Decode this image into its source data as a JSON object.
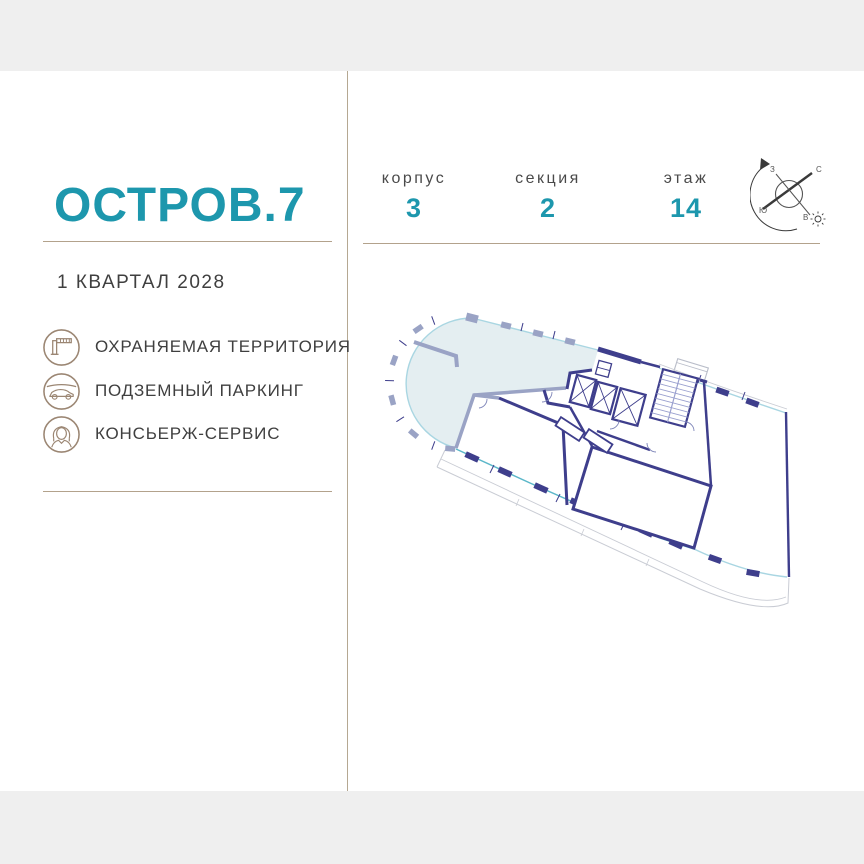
{
  "brand": {
    "logo": "ОСТРОВ.7",
    "completion": "1 КВАРТАЛ 2028",
    "accent_color": "#1d97ad",
    "line_color": "#b3a28c"
  },
  "amenities": [
    {
      "icon": "barrier-icon",
      "label": "ОХРАНЯЕМАЯ ТЕРРИТОРИЯ"
    },
    {
      "icon": "car-icon",
      "label": "ПОДЗЕМНЫЙ ПАРКИНГ"
    },
    {
      "icon": "concierge-icon",
      "label": "КОНСЬЕРЖ-СЕРВИС"
    }
  ],
  "header": {
    "items": [
      {
        "label": "корпус",
        "value": "3"
      },
      {
        "label": "секция",
        "value": "2"
      },
      {
        "label": "этаж",
        "value": "14"
      }
    ]
  },
  "compass": {
    "north": "С",
    "south": "Ю",
    "west": "З",
    "east": "В"
  },
  "floorplan": {
    "highlight_fill": "#e4eef1",
    "wall_dark": "#3e3e8c",
    "wall_gray": "#9aa3c5",
    "glass": "#5bb7c9",
    "glass_light": "#a9d6e2",
    "balcony_outline": "#c9ccd4",
    "band_color": "#efefef",
    "icon_color": "#9b8673"
  }
}
